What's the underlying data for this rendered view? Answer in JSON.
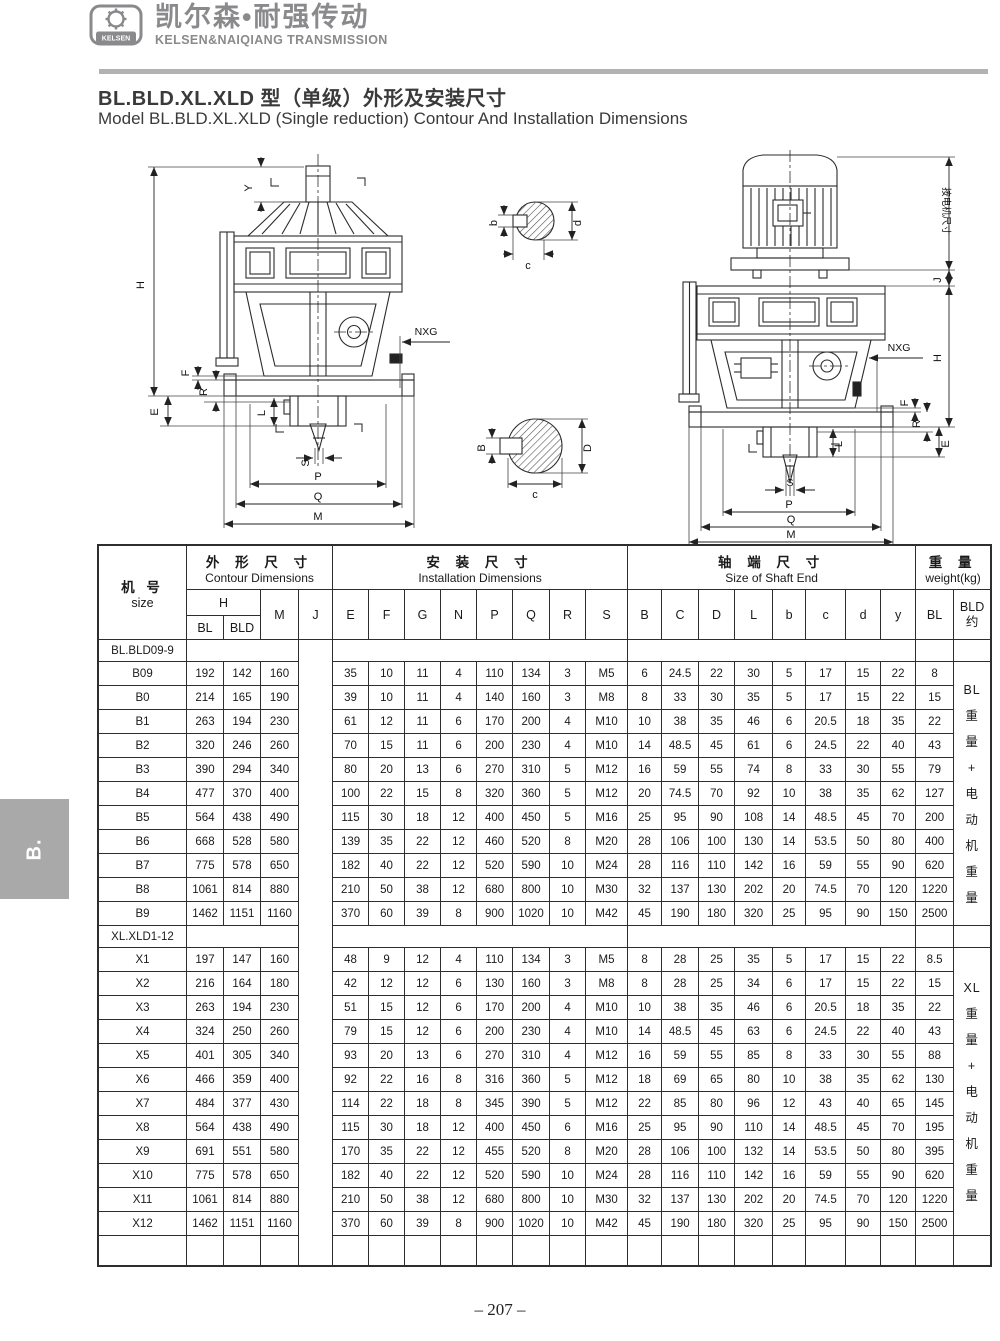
{
  "logo": {
    "badge": "KELSEN",
    "cn": "凯尔森•耐强传动",
    "en": "KELSEN&NAIQIANG TRANSMISSION"
  },
  "title": {
    "cn": "BL.BLD.XL.XLD 型（单级）外形及安装尺寸",
    "en": "Model BL.BLD.XL.XLD (Single reduction) Contour And Installation Dimensions"
  },
  "side_tab": "B.",
  "page_number": "– 207 –",
  "drawings": {
    "left": {
      "Y": "Y",
      "H": "H",
      "F": "F",
      "R": "R",
      "E": "E",
      "NXG": "NXG",
      "L": "L",
      "S": "S",
      "P": "P",
      "Q": "Q",
      "M": "M"
    },
    "right": {
      "motor_note": "按电机尺寸",
      "J": "J",
      "H": "H",
      "F": "F",
      "R": "R",
      "E": "E",
      "NXG": "NXG",
      "L": "L",
      "S": "S",
      "P": "P",
      "Q": "Q",
      "M": "M"
    },
    "section_small": {
      "b": "b",
      "c": "c",
      "d": "d"
    },
    "section_large": {
      "B": "B",
      "c": "c",
      "D": "D"
    }
  },
  "table": {
    "headers": {
      "size_cn": "机 号",
      "size_en": "size",
      "contour_cn": "外 形 尺 寸",
      "contour_en": "Contour Dimensions",
      "install_cn": "安 装 尺 寸",
      "install_en": "Installation Dimensions",
      "shaft_cn": "轴 端 尺 寸",
      "shaft_en": "Size of Shaft End",
      "weight_cn": "重 量",
      "weight_en": "weight(kg)",
      "h_label": "H",
      "h_sub": [
        "BL",
        "BLD"
      ],
      "m": "M",
      "j": "J",
      "install_cols": [
        "E",
        "F",
        "G",
        "N",
        "P",
        "Q",
        "R",
        "S"
      ],
      "shaft_cols": [
        "B",
        "C",
        "D",
        "L",
        "b",
        "c",
        "d",
        "y"
      ],
      "weight_bl": "BL",
      "weight_bld_1": "BLD",
      "weight_bld_2": "约"
    },
    "sections": [
      {
        "label": "BL.BLD09-9",
        "weight_note_lines": [
          "BL",
          "重",
          "量",
          "+",
          "电",
          "动",
          "机",
          "重",
          "量"
        ],
        "rows": [
          [
            "B09",
            "192",
            "142",
            "160",
            "35",
            "10",
            "11",
            "4",
            "110",
            "134",
            "3",
            "M5",
            "6",
            "24.5",
            "22",
            "30",
            "5",
            "17",
            "15",
            "22",
            "8"
          ],
          [
            "B0",
            "214",
            "165",
            "190",
            "39",
            "10",
            "11",
            "4",
            "140",
            "160",
            "3",
            "M8",
            "8",
            "33",
            "30",
            "35",
            "5",
            "17",
            "15",
            "22",
            "15"
          ],
          [
            "B1",
            "263",
            "194",
            "230",
            "61",
            "12",
            "11",
            "6",
            "170",
            "200",
            "4",
            "M10",
            "10",
            "38",
            "35",
            "46",
            "6",
            "20.5",
            "18",
            "35",
            "22"
          ],
          [
            "B2",
            "320",
            "246",
            "260",
            "70",
            "15",
            "11",
            "6",
            "200",
            "230",
            "4",
            "M10",
            "14",
            "48.5",
            "45",
            "61",
            "6",
            "24.5",
            "22",
            "40",
            "43"
          ],
          [
            "B3",
            "390",
            "294",
            "340",
            "80",
            "20",
            "13",
            "6",
            "270",
            "310",
            "5",
            "M12",
            "16",
            "59",
            "55",
            "74",
            "8",
            "33",
            "30",
            "55",
            "79"
          ],
          [
            "B4",
            "477",
            "370",
            "400",
            "100",
            "22",
            "15",
            "8",
            "320",
            "360",
            "5",
            "M12",
            "20",
            "74.5",
            "70",
            "92",
            "10",
            "38",
            "35",
            "62",
            "127"
          ],
          [
            "B5",
            "564",
            "438",
            "490",
            "115",
            "30",
            "18",
            "12",
            "400",
            "450",
            "5",
            "M16",
            "25",
            "95",
            "90",
            "108",
            "14",
            "48.5",
            "45",
            "70",
            "200"
          ],
          [
            "B6",
            "668",
            "528",
            "580",
            "139",
            "35",
            "22",
            "12",
            "460",
            "520",
            "8",
            "M20",
            "28",
            "106",
            "100",
            "130",
            "14",
            "53.5",
            "50",
            "80",
            "400"
          ],
          [
            "B7",
            "775",
            "578",
            "650",
            "182",
            "40",
            "22",
            "12",
            "520",
            "590",
            "10",
            "M24",
            "28",
            "116",
            "110",
            "142",
            "16",
            "59",
            "55",
            "90",
            "620"
          ],
          [
            "B8",
            "1061",
            "814",
            "880",
            "210",
            "50",
            "38",
            "12",
            "680",
            "800",
            "10",
            "M30",
            "32",
            "137",
            "130",
            "202",
            "20",
            "74.5",
            "70",
            "120",
            "1220"
          ],
          [
            "B9",
            "1462",
            "1151",
            "1160",
            "370",
            "60",
            "39",
            "8",
            "900",
            "1020",
            "10",
            "M42",
            "45",
            "190",
            "180",
            "320",
            "25",
            "95",
            "90",
            "150",
            "2500"
          ]
        ]
      },
      {
        "label": "XL.XLD1-12",
        "weight_note_lines": [
          "XL",
          "重",
          "量",
          "+",
          "电",
          "动",
          "机",
          "重",
          "量"
        ],
        "rows": [
          [
            "X1",
            "197",
            "147",
            "160",
            "48",
            "9",
            "12",
            "4",
            "110",
            "134",
            "3",
            "M5",
            "8",
            "28",
            "25",
            "35",
            "5",
            "17",
            "15",
            "22",
            "8.5"
          ],
          [
            "X2",
            "216",
            "164",
            "180",
            "42",
            "12",
            "12",
            "6",
            "130",
            "160",
            "3",
            "M8",
            "8",
            "28",
            "25",
            "34",
            "6",
            "17",
            "15",
            "22",
            "15"
          ],
          [
            "X3",
            "263",
            "194",
            "230",
            "51",
            "15",
            "12",
            "6",
            "170",
            "200",
            "4",
            "M10",
            "10",
            "38",
            "35",
            "46",
            "6",
            "20.5",
            "18",
            "35",
            "22"
          ],
          [
            "X4",
            "324",
            "250",
            "260",
            "79",
            "15",
            "12",
            "6",
            "200",
            "230",
            "4",
            "M10",
            "14",
            "48.5",
            "45",
            "63",
            "6",
            "24.5",
            "22",
            "40",
            "43"
          ],
          [
            "X5",
            "401",
            "305",
            "340",
            "93",
            "20",
            "13",
            "6",
            "270",
            "310",
            "4",
            "M12",
            "16",
            "59",
            "55",
            "85",
            "8",
            "33",
            "30",
            "55",
            "88"
          ],
          [
            "X6",
            "466",
            "359",
            "400",
            "92",
            "22",
            "16",
            "8",
            "316",
            "360",
            "5",
            "M12",
            "18",
            "69",
            "65",
            "80",
            "10",
            "38",
            "35",
            "62",
            "130"
          ],
          [
            "X7",
            "484",
            "377",
            "430",
            "114",
            "22",
            "18",
            "8",
            "345",
            "390",
            "5",
            "M12",
            "22",
            "85",
            "80",
            "96",
            "12",
            "43",
            "40",
            "65",
            "145"
          ],
          [
            "X8",
            "564",
            "438",
            "490",
            "115",
            "30",
            "18",
            "12",
            "400",
            "450",
            "6",
            "M16",
            "25",
            "95",
            "90",
            "110",
            "14",
            "48.5",
            "45",
            "70",
            "195"
          ],
          [
            "X9",
            "691",
            "551",
            "580",
            "170",
            "35",
            "22",
            "12",
            "455",
            "520",
            "8",
            "M20",
            "28",
            "106",
            "100",
            "132",
            "14",
            "53.5",
            "50",
            "80",
            "395"
          ],
          [
            "X10",
            "775",
            "578",
            "650",
            "182",
            "40",
            "22",
            "12",
            "520",
            "590",
            "10",
            "M24",
            "28",
            "116",
            "110",
            "142",
            "16",
            "59",
            "55",
            "90",
            "620"
          ],
          [
            "X11",
            "1061",
            "814",
            "880",
            "210",
            "50",
            "38",
            "12",
            "680",
            "800",
            "10",
            "M30",
            "32",
            "137",
            "130",
            "202",
            "20",
            "74.5",
            "70",
            "120",
            "1220"
          ],
          [
            "X12",
            "1462",
            "1151",
            "1160",
            "370",
            "60",
            "39",
            "8",
            "900",
            "1020",
            "10",
            "M42",
            "45",
            "190",
            "180",
            "320",
            "25",
            "95",
            "90",
            "150",
            "2500"
          ]
        ]
      }
    ]
  }
}
